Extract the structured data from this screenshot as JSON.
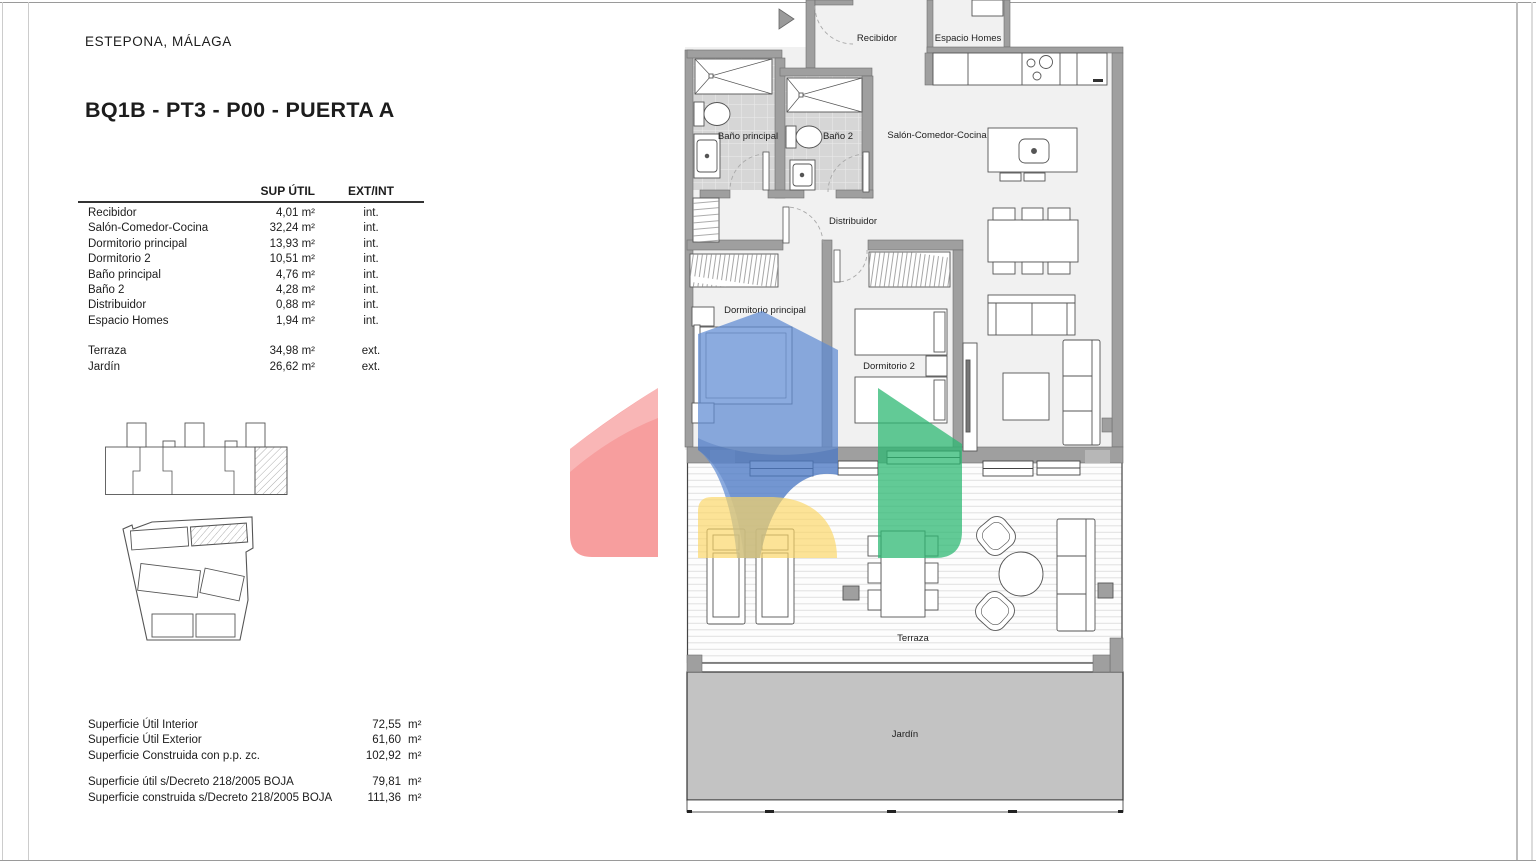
{
  "page": {
    "location": "ESTEPONA, MÁLAGA",
    "title": "BQ1B - PT3 - P00 -  PUERTA A"
  },
  "area_table": {
    "col_area": "SUP ÚTIL",
    "col_type": "EXT/INT",
    "rows": [
      {
        "name": "Recibidor",
        "area": "4,01 m²",
        "type": "int."
      },
      {
        "name": "Salón-Comedor-Cocina",
        "area": "32,24 m²",
        "type": "int."
      },
      {
        "name": "Dormitorio principal",
        "area": "13,93 m²",
        "type": "int."
      },
      {
        "name": "Dormitorio 2",
        "area": "10,51 m²",
        "type": "int."
      },
      {
        "name": "Baño principal",
        "area": "4,76 m²",
        "type": "int."
      },
      {
        "name": "Baño 2",
        "area": "4,28 m²",
        "type": "int."
      },
      {
        "name": "Distribuidor",
        "area": "0,88 m²",
        "type": "int."
      },
      {
        "name": "Espacio Homes",
        "area": "1,94 m²",
        "type": "int."
      }
    ],
    "ext_rows": [
      {
        "name": "Terraza",
        "area": "34,98 m²",
        "type": "ext."
      },
      {
        "name": "Jardín",
        "area": "26,62 m²",
        "type": "ext."
      }
    ]
  },
  "totals": {
    "rows": [
      {
        "label": "Superficie Útil Interior",
        "value": "72,55",
        "unit": "m²"
      },
      {
        "label": "Superficie Útil Exterior",
        "value": "61,60",
        "unit": "m²"
      },
      {
        "label": "Superficie Construida con p.p. zc.",
        "value": "102,92",
        "unit": "m²"
      }
    ],
    "decree_rows": [
      {
        "label": "Superficie útil s/Decreto 218/2005 BOJA",
        "value": "79,81",
        "unit": "m²"
      },
      {
        "label": "Superficie construida s/Decreto 218/2005 BOJA",
        "value": "111,36",
        "unit": "m²"
      }
    ]
  },
  "plan": {
    "labels": {
      "recibidor": "Recibidor",
      "espacio_homes": "Espacio Homes",
      "bano_principal": "Baño principal",
      "bano_2": "Baño 2",
      "salon": "Salón-Comedor-Cocina",
      "distribuidor": "Distribuidor",
      "dormitorio_principal": "Dormitorio principal",
      "dormitorio_2": "Dormitorio 2",
      "terraza": "Terraza",
      "jardin": "Jardín"
    },
    "watermark_colors": {
      "red": "#f47878",
      "blue": "#5e8bd2",
      "green": "#2eb873",
      "yellow": "#fbd565"
    }
  }
}
